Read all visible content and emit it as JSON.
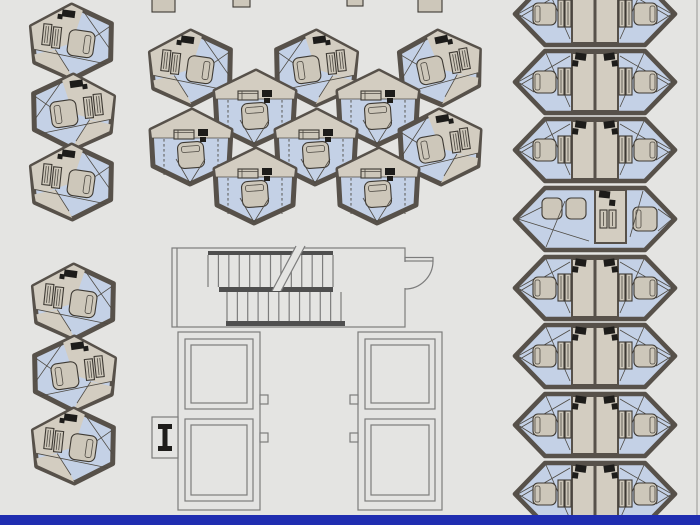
{
  "canvas": {
    "width": 700,
    "height": 525
  },
  "palette": {
    "bg": "#e4e4e2",
    "wall": "#57514a",
    "floor_blue": "#c4d1e6",
    "floor_tan": "#d3cdc1",
    "furn": "#cdc7ba",
    "furn_stroke": "#3e3a34",
    "detail": "#4e4a43",
    "black": "#1d1c1a",
    "plan_line": "#7c7c7c",
    "plan_band": "#4f4f4f",
    "footer": "#1f2db0",
    "edge_line": "#bdbdbb"
  },
  "pods": {
    "left_column_groups": [
      {
        "hexes": [
          {
            "cx": 72,
            "cy": 42,
            "mirror": false,
            "rot": -2
          },
          {
            "cx": 73,
            "cy": 112,
            "mirror": true,
            "rot": 2
          },
          {
            "cx": 72,
            "cy": 182,
            "mirror": false,
            "rot": -2
          }
        ]
      },
      {
        "hexes": [
          {
            "cx": 74,
            "cy": 302,
            "mirror": false,
            "rot": -2
          },
          {
            "cx": 74,
            "cy": 374,
            "mirror": true,
            "rot": 2
          },
          {
            "cx": 74,
            "cy": 446,
            "mirror": false,
            "rot": -2
          }
        ]
      }
    ],
    "cluster_hexes": [
      {
        "cx": 191,
        "cy": 68,
        "type": "T",
        "mirror": false,
        "rot": -2
      },
      {
        "cx": 316,
        "cy": 68,
        "type": "T",
        "mirror": true,
        "rot": 2
      },
      {
        "cx": 440,
        "cy": 68,
        "type": "T",
        "mirror": true,
        "rot": -2
      },
      {
        "cx": 255,
        "cy": 108,
        "type": "V",
        "mirror": false,
        "rot": 0
      },
      {
        "cx": 378,
        "cy": 108,
        "type": "V",
        "mirror": false,
        "rot": 0
      },
      {
        "cx": 191,
        "cy": 147,
        "type": "V",
        "mirror": false,
        "rot": 0
      },
      {
        "cx": 316,
        "cy": 147,
        "type": "V",
        "mirror": false,
        "rot": 0
      },
      {
        "cx": 440,
        "cy": 147,
        "type": "T",
        "mirror": true,
        "rot": 0
      },
      {
        "cx": 255,
        "cy": 186,
        "type": "V",
        "mirror": false,
        "rot": 0
      },
      {
        "cx": 378,
        "cy": 186,
        "type": "V",
        "mirror": false,
        "rot": 0
      }
    ],
    "right_strip": {
      "cx": 595,
      "rows": [
        {
          "cy": 14,
          "type": "pair"
        },
        {
          "cy": 82,
          "type": "pair"
        },
        {
          "cy": 150,
          "type": "pair"
        },
        {
          "cy": 219,
          "type": "lounge"
        },
        {
          "cy": 288,
          "type": "pair"
        },
        {
          "cy": 356,
          "type": "pair"
        },
        {
          "cy": 425,
          "type": "pair"
        },
        {
          "cy": 494,
          "type": "pair"
        }
      ]
    }
  },
  "top_fragments": [
    {
      "x": 152,
      "y": -4,
      "w": 23,
      "h": 16
    },
    {
      "x": 233,
      "y": -4,
      "w": 17,
      "h": 11
    },
    {
      "x": 347,
      "y": -4,
      "w": 16,
      "h": 10
    },
    {
      "x": 418,
      "y": -4,
      "w": 24,
      "h": 16
    }
  ],
  "core_plan": {
    "hall": {
      "x": 172,
      "y": 248,
      "w": 233,
      "h": 79,
      "inner_left_x": 177
    },
    "door": {
      "hinge_x": 405,
      "top_y": 260,
      "tip_x": 433,
      "open_bottom_y": 289
    },
    "stairs": {
      "bands": [
        {
          "x": 208,
          "y": 251,
          "w": 125,
          "h": 4
        },
        {
          "x": 219,
          "y": 287,
          "w": 114,
          "h": 5
        },
        {
          "x": 226,
          "y": 321,
          "w": 119,
          "h": 5
        }
      ],
      "upper_treads": {
        "x1": 208,
        "x2": 333,
        "count": 13,
        "y1": 255,
        "y2": 287
      },
      "lower_treads": {
        "x1": 227,
        "x2": 341,
        "count": 12,
        "y1": 292,
        "y2": 321
      },
      "break_line": {
        "top_x": 296,
        "top_y": 246,
        "bot_x": 272,
        "bot_y": 291,
        "gap": 9
      }
    },
    "towers": [
      {
        "x": 178,
        "y": 332,
        "w": 82,
        "h": 178,
        "notch_side": "right"
      },
      {
        "x": 358,
        "y": 332,
        "w": 84,
        "h": 178,
        "notch_side": "left"
      }
    ],
    "shafts": [
      {
        "y": 339,
        "h": 70
      },
      {
        "y": 419,
        "h": 82
      }
    ],
    "shaft_inset": 7,
    "shaft_inner_inset": 13,
    "notch_ys": [
      395,
      433
    ],
    "column_symbol": {
      "x": 152,
      "y": 417,
      "w": 26,
      "h": 41
    }
  },
  "footer_bar": {
    "x": 0,
    "y": 515,
    "w": 700,
    "h": 10
  },
  "right_edge_line": {
    "x": 696,
    "w": 2
  },
  "glyphs": [
    "bed",
    "wardrobe",
    "dresser",
    "desk-with-chair",
    "stair-treads",
    "door-swing",
    "elevator-shaft",
    "steel-column"
  ]
}
